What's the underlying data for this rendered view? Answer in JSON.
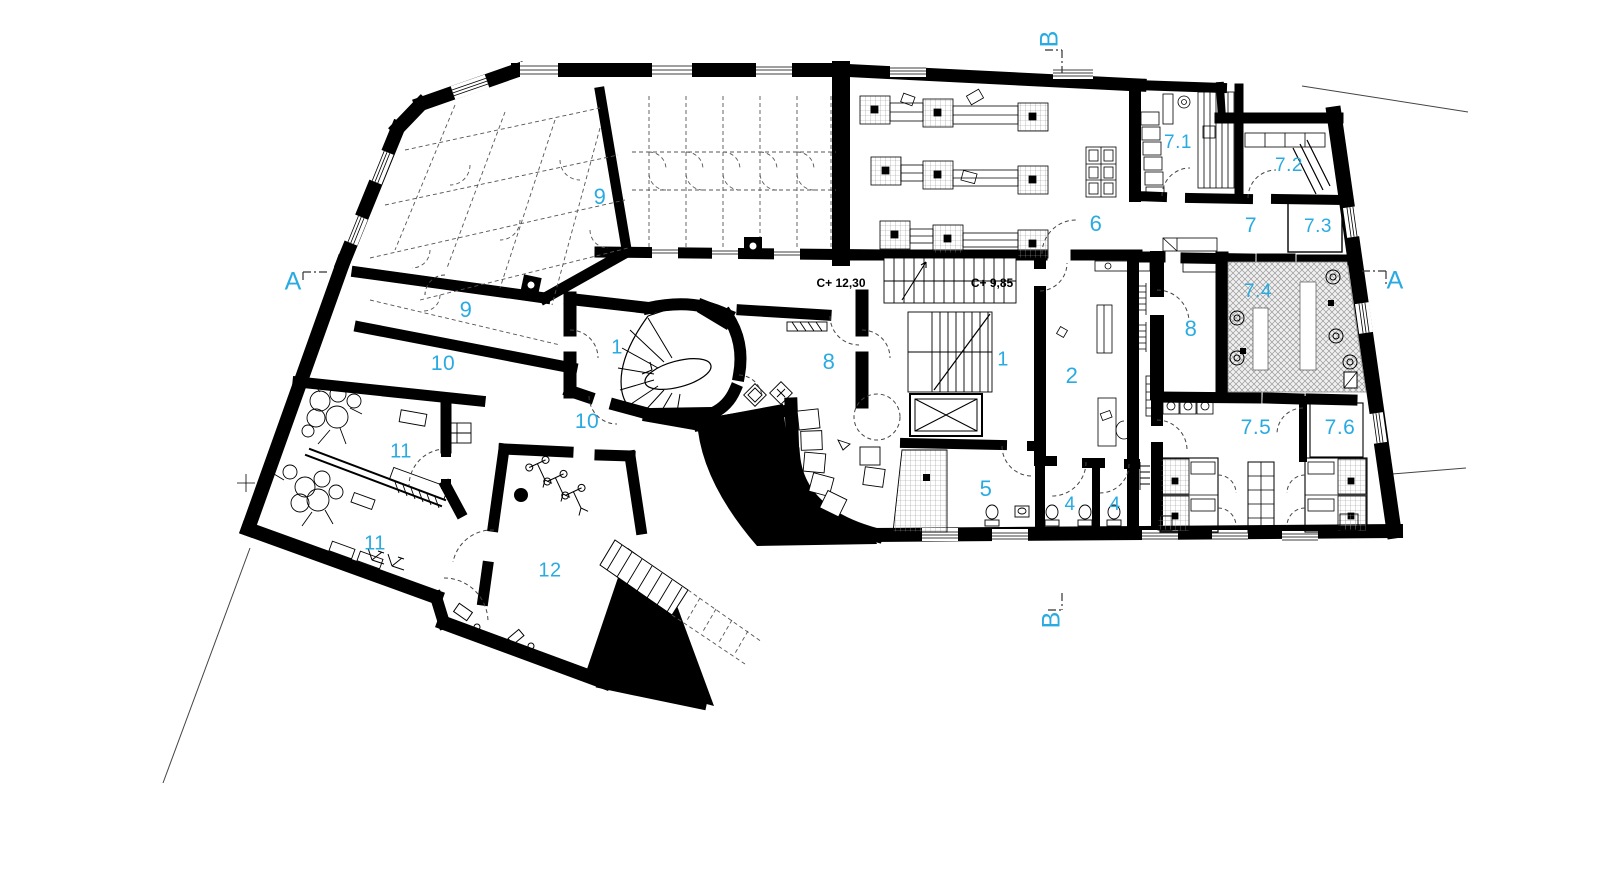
{
  "drawing": {
    "type": "architectural-floor-plan",
    "accent_color": "#29ABE2",
    "line_color": "#000000",
    "background_color": "#ffffff"
  },
  "room_labels": [
    {
      "id": "9-upper",
      "text": "9"
    },
    {
      "id": "9-lower",
      "text": "9"
    },
    {
      "id": "10-upper",
      "text": "10"
    },
    {
      "id": "10-lower",
      "text": "10"
    },
    {
      "id": "11-upper",
      "text": "11"
    },
    {
      "id": "11-lower",
      "text": "11"
    },
    {
      "id": "12",
      "text": "12"
    },
    {
      "id": "1-left",
      "text": "1"
    },
    {
      "id": "8-left",
      "text": "8"
    },
    {
      "id": "1-right",
      "text": "1"
    },
    {
      "id": "2",
      "text": "2"
    },
    {
      "id": "5",
      "text": "5"
    },
    {
      "id": "4-left",
      "text": "4"
    },
    {
      "id": "4-right",
      "text": "4"
    },
    {
      "id": "6",
      "text": "6"
    },
    {
      "id": "7-1",
      "text": "7.1"
    },
    {
      "id": "7-2",
      "text": "7.2"
    },
    {
      "id": "7",
      "text": "7"
    },
    {
      "id": "7-3",
      "text": "7.3"
    },
    {
      "id": "8-right",
      "text": "8"
    },
    {
      "id": "7-4",
      "text": "7.4"
    },
    {
      "id": "7-5",
      "text": "7.5"
    },
    {
      "id": "7-6",
      "text": "7.6"
    }
  ],
  "level_annotations": [
    {
      "id": "upper-landing",
      "text": "C+ 12,30"
    },
    {
      "id": "lower-landing",
      "text": "C+ 9,85"
    }
  ],
  "section_markers": [
    {
      "id": "a-left",
      "text": "A"
    },
    {
      "id": "a-right",
      "text": "A"
    },
    {
      "id": "b-top",
      "text": "B"
    },
    {
      "id": "b-bottom",
      "text": "B"
    }
  ]
}
